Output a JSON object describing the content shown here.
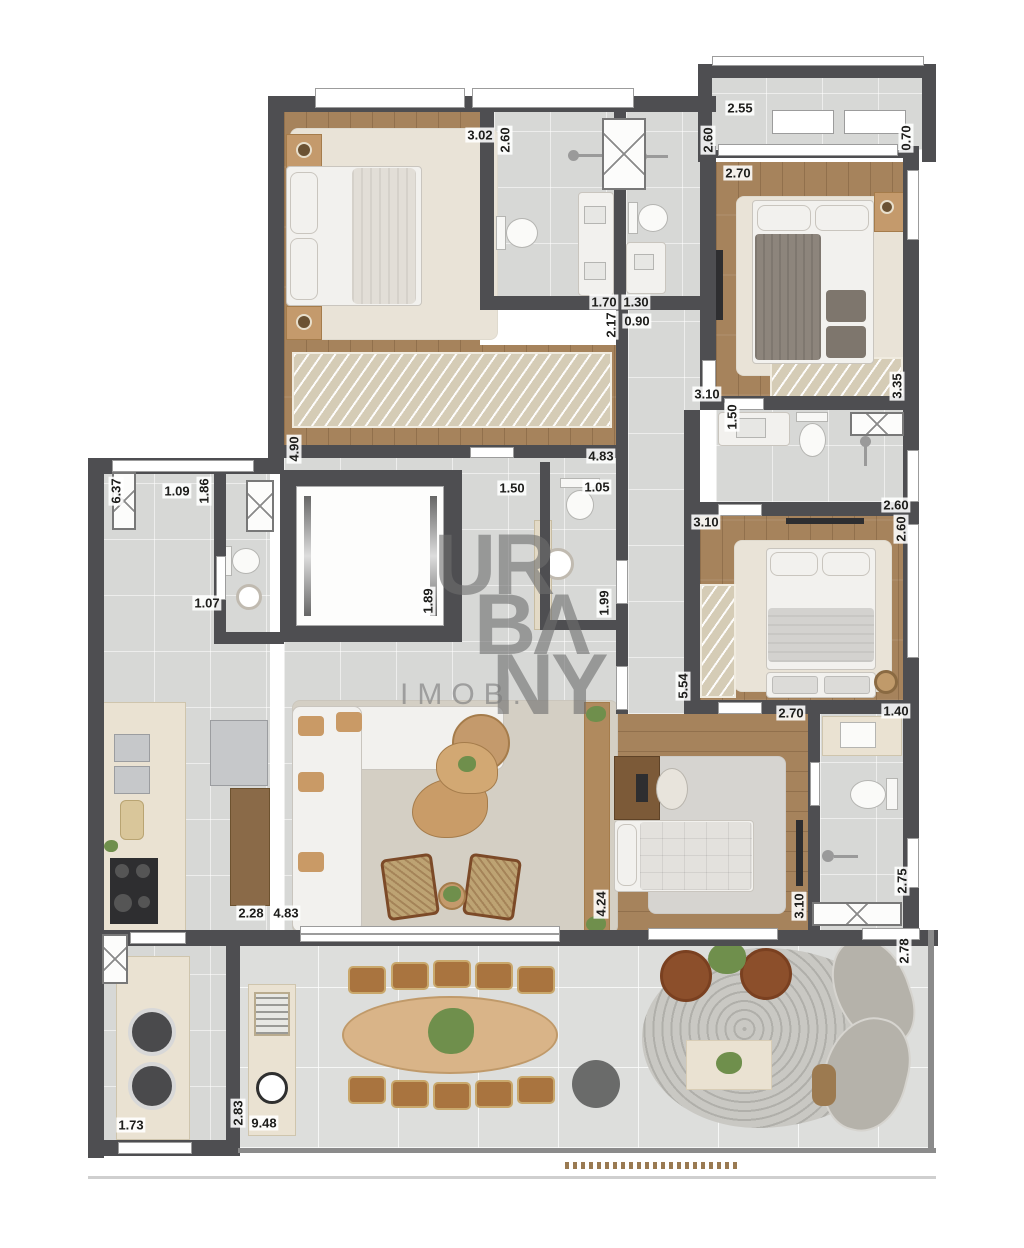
{
  "watermark": {
    "line1": "UR",
    "line2": "BΛ",
    "line3": "NY",
    "imob": "IMOB."
  },
  "palette": {
    "wall": "#4e4e51",
    "wood": "#a6835c",
    "tile": "#d7d8d6",
    "terrace": "#dddedc",
    "closet": "#d5ccb6",
    "counter": "#eae2d2",
    "accent_wood": "#c49a6c",
    "label": "#1d1d1b"
  },
  "dimensions": [
    {
      "label": "3.02",
      "x": 480,
      "y": 135,
      "o": "h"
    },
    {
      "label": "2.60",
      "x": 505,
      "y": 140,
      "o": "v"
    },
    {
      "label": "2.60",
      "x": 708,
      "y": 140,
      "o": "v"
    },
    {
      "label": "2.55",
      "x": 740,
      "y": 108,
      "o": "h"
    },
    {
      "label": "0.70",
      "x": 906,
      "y": 138,
      "o": "v"
    },
    {
      "label": "2.70",
      "x": 738,
      "y": 173,
      "o": "h"
    },
    {
      "label": "1.70",
      "x": 604,
      "y": 302,
      "o": "h"
    },
    {
      "label": "1.30",
      "x": 636,
      "y": 302,
      "o": "h"
    },
    {
      "label": "0.90",
      "x": 637,
      "y": 321,
      "o": "h"
    },
    {
      "label": "2.17",
      "x": 611,
      "y": 325,
      "o": "v"
    },
    {
      "label": "3.35",
      "x": 897,
      "y": 386,
      "o": "v"
    },
    {
      "label": "3.10",
      "x": 707,
      "y": 394,
      "o": "h"
    },
    {
      "label": "1.50",
      "x": 732,
      "y": 417,
      "o": "v"
    },
    {
      "label": "1.50",
      "x": 512,
      "y": 488,
      "o": "h"
    },
    {
      "label": "1.05",
      "x": 597,
      "y": 487,
      "o": "h"
    },
    {
      "label": "2.60",
      "x": 896,
      "y": 505,
      "o": "h"
    },
    {
      "label": "3.10",
      "x": 706,
      "y": 522,
      "o": "h"
    },
    {
      "label": "2.60",
      "x": 901,
      "y": 529,
      "o": "v"
    },
    {
      "label": "6.37",
      "x": 116,
      "y": 491,
      "o": "v"
    },
    {
      "label": "1.09",
      "x": 177,
      "y": 491,
      "o": "h"
    },
    {
      "label": "1.86",
      "x": 204,
      "y": 491,
      "o": "v"
    },
    {
      "label": "4.90",
      "x": 294,
      "y": 449,
      "o": "v"
    },
    {
      "label": "4.83",
      "x": 601,
      "y": 456,
      "o": "h"
    },
    {
      "label": "1.07",
      "x": 207,
      "y": 603,
      "o": "h"
    },
    {
      "label": "1.89",
      "x": 428,
      "y": 601,
      "o": "v"
    },
    {
      "label": "1.99",
      "x": 604,
      "y": 603,
      "o": "v"
    },
    {
      "label": "5.54",
      "x": 683,
      "y": 686,
      "o": "v"
    },
    {
      "label": "2.70",
      "x": 791,
      "y": 713,
      "o": "h"
    },
    {
      "label": "1.40",
      "x": 896,
      "y": 711,
      "o": "h"
    },
    {
      "label": "4.24",
      "x": 601,
      "y": 904,
      "o": "v"
    },
    {
      "label": "3.10",
      "x": 799,
      "y": 906,
      "o": "v"
    },
    {
      "label": "2.75",
      "x": 902,
      "y": 881,
      "o": "v"
    },
    {
      "label": "2.78",
      "x": 904,
      "y": 951,
      "o": "v"
    },
    {
      "label": "2.28",
      "x": 251,
      "y": 913,
      "o": "h"
    },
    {
      "label": "4.83",
      "x": 286,
      "y": 913,
      "o": "h"
    },
    {
      "label": "1.73",
      "x": 131,
      "y": 1125,
      "o": "h"
    },
    {
      "label": "9.48",
      "x": 264,
      "y": 1123,
      "o": "h"
    },
    {
      "label": "2.83",
      "x": 238,
      "y": 1113,
      "o": "v"
    }
  ]
}
